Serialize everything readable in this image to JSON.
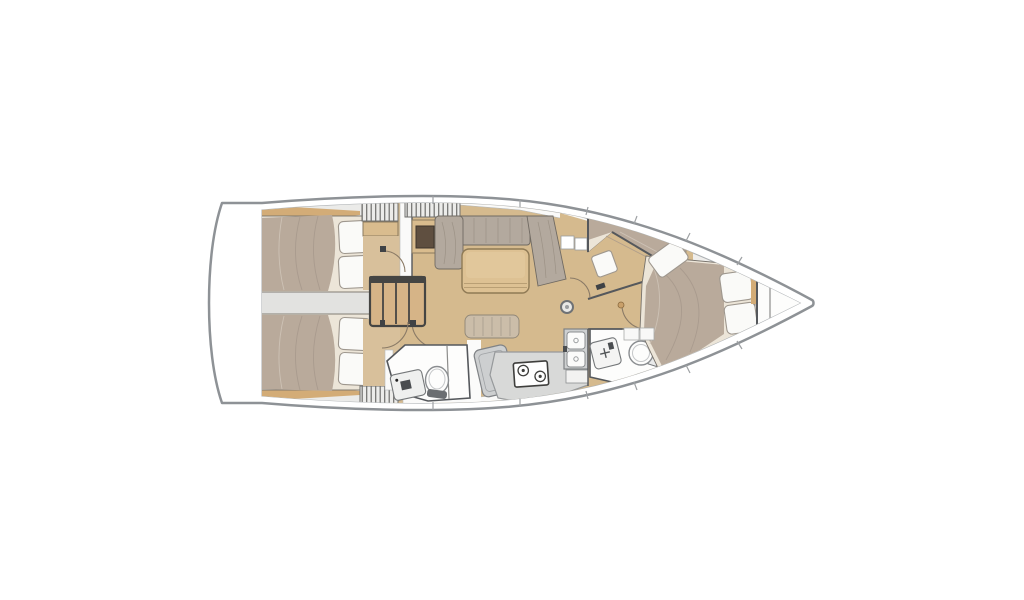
{
  "document": {
    "type": "boat-floor-plan",
    "label": "Sailing yacht interior layout floor plan, bow facing right",
    "orientation": "bow-right"
  },
  "palette": {
    "bg": "#ffffff",
    "hull-stroke": "#8e9296",
    "deck": "#ffffff",
    "interior": "#efeeec",
    "cabin-base": "#ebebe9",
    "floor": "#d5ba8e",
    "floor-light": "#d8c09b",
    "wood": "#d3ac77",
    "wood-mid": "#d9bc8e",
    "table": "#ddc193",
    "mattress": "#b9aa9b",
    "mattress-shade": "#a4958a",
    "sheet": "#ece5d8",
    "pillow": "#fafaf8",
    "pillow-stroke": "#9e978e",
    "cushion": "#b3a99e",
    "seatpad": "#cbbda9",
    "gray-furn": "#d8d9d8",
    "gray-furn2": "#cdcfd0",
    "gray-band": "#e2e2e0",
    "fixture-stroke": "#8a8d90",
    "wall": "#55585c",
    "wall-light": "#8d8d8b",
    "door-arc": "#8a7a66",
    "hatch-bg": "#ececea",
    "hatch-line": "#6e6e6c",
    "dark-inset": "#5f4f40",
    "white-strip": "#fafaf9",
    "stairs-wood": "#d6b487",
    "stairs-dark": "#454543",
    "counter-stroke": "#96999b"
  },
  "components": [
    {
      "id": "swim-platform",
      "label": "Transom swim platform"
    },
    {
      "id": "aft-cabin-port",
      "label": "Aft double cabin, port"
    },
    {
      "id": "aft-cabin-starboard",
      "label": "Aft double cabin, starboard"
    },
    {
      "id": "engine-compartment",
      "label": "Engine box between aft berths"
    },
    {
      "id": "companionway-stairs",
      "label": "Companionway steps"
    },
    {
      "id": "aft-heads",
      "label": "Aft heads with toilet and sink"
    },
    {
      "id": "nav-station",
      "label": "Chart table and seat"
    },
    {
      "id": "salon-settee",
      "label": "Salon U-settee"
    },
    {
      "id": "salon-table",
      "label": "Salon table"
    },
    {
      "id": "mast-post",
      "label": "Mast compression post"
    },
    {
      "id": "galley",
      "label": "Galley with stove, double sink, fridge"
    },
    {
      "id": "forward-heads",
      "label": "Forward heads with toilet and sink"
    },
    {
      "id": "forward-berth-port",
      "label": "Angled forward berth, port"
    },
    {
      "id": "forward-cabin",
      "label": "Forward cabin double bed"
    },
    {
      "id": "bow-locker",
      "label": "Bow anchor locker"
    }
  ]
}
